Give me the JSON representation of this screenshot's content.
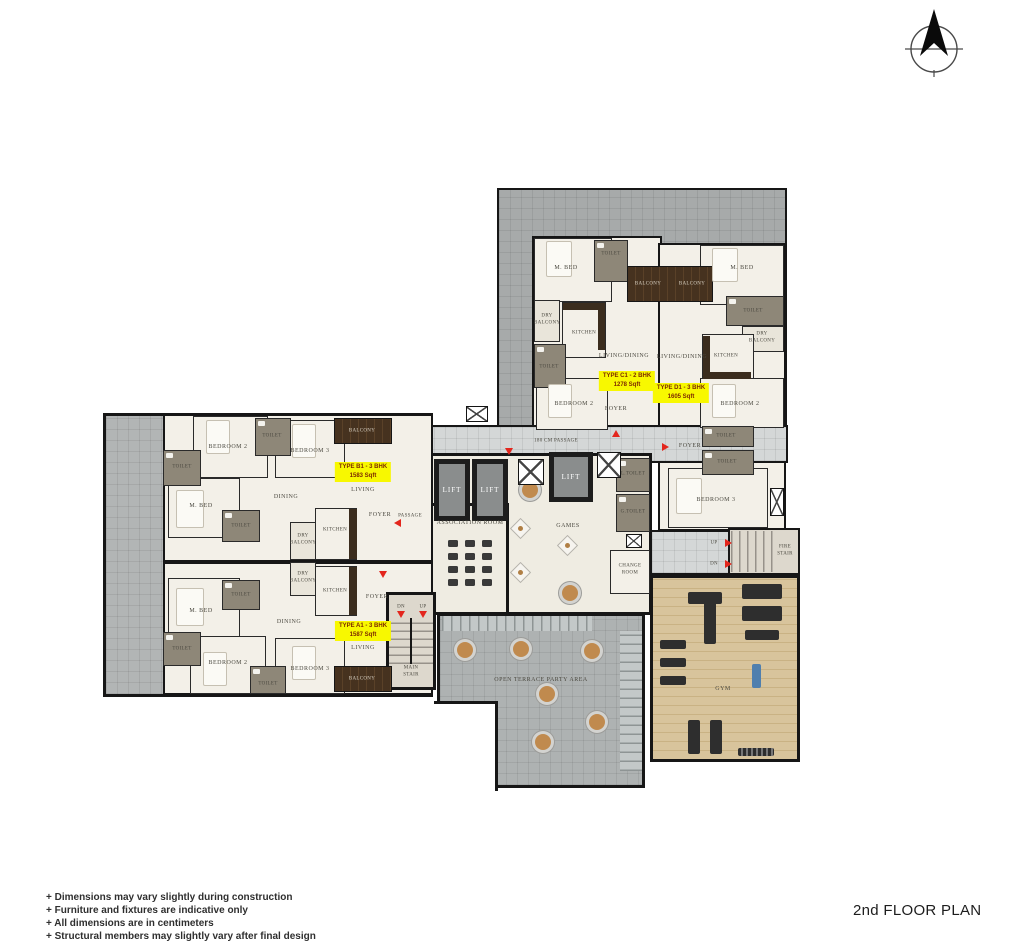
{
  "meta": {
    "title": "2nd FLOOR PLAN"
  },
  "notes": [
    "+ Dimensions may vary slightly during construction",
    "+ Furniture and fixtures are indicative only",
    "+ All dimensions are in centimeters",
    "+ Structural members may slightly vary after final design"
  ],
  "labels": {
    "m_bed": "M. BED",
    "bedroom_2": "BEDROOM 2",
    "bedroom_3": "BEDROOM 3",
    "toilet": "TOILET",
    "kitchen": "KITCHEN",
    "dining": "DINING",
    "living": "LIVING",
    "living_dining": "LIVING/DINING",
    "foyer": "FOYER",
    "balcony": "BALCONY",
    "dry_balcony": "DRY BALCONY",
    "passage": "PASSAGE",
    "main_passage": "180 CM PASSAGE",
    "lift": "LIFT",
    "association_room": "ASSOCIATION ROOM",
    "games": "GAMES",
    "l_toilet": "L.TOILET",
    "g_toilet": "G.TOILET",
    "change_room": "CHANGE ROOM",
    "open_terrace": "OPEN TERRACE PARTY AREA",
    "gym": "GYM",
    "main_stair": "MAIN STAIR",
    "fire_stair": "FIRE STAIR",
    "up": "UP",
    "dn": "DN"
  },
  "units": {
    "a1": {
      "type": "TYPE A1 - 3 BHK",
      "area": "1587 Sqft"
    },
    "b1": {
      "type": "TYPE B1 - 3 BHK",
      "area": "1583 Sqft"
    },
    "c1": {
      "type": "TYPE C1 - 2 BHK",
      "area": "1278 Sqft"
    },
    "d1": {
      "type": "TYPE D1 - 3 BHK",
      "area": "1605 Sqft"
    }
  },
  "icons": {
    "north_arrow": "north-arrow"
  },
  "colors": {
    "badge_bg": "#f8f800",
    "badge_text": "#7d2b00",
    "arrow_red": "#e3261d",
    "wall": "#161616",
    "terrace_gray": "#b2b5b5",
    "roof_gray": "#a7aaaa",
    "passage_gray": "#d4d7d7",
    "room_cream": "#f3f0e8",
    "toilet_gray": "#8e8778",
    "balcony_wood": "#46321f",
    "gym_wood": "#d8c49c"
  }
}
